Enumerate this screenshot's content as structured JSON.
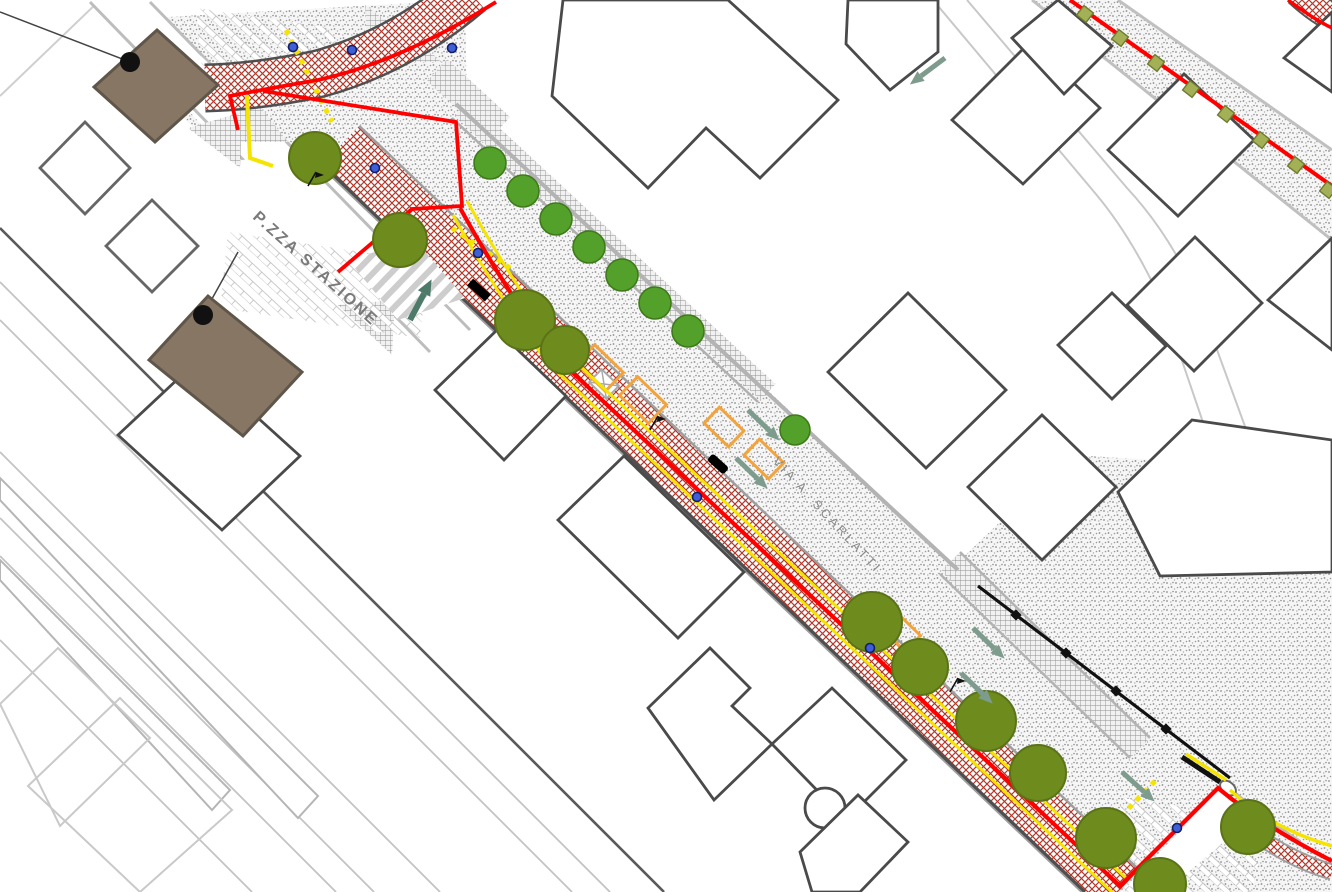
{
  "labels": {
    "piazza": "P.ZZA STAZIONE",
    "via": "VIA A. SCARLATTI"
  },
  "palette": {
    "project_boundary_red": "#FF0000",
    "lane_yellow": "#F5E400",
    "paving_crosshatch_red": "#B2392C",
    "tree_olive": "#6E8B1E",
    "tree_bright_green": "#53A02B",
    "station_building_brown": "#877663",
    "building_outline_gray": "#4A4A4A",
    "curb_gray": "#B3B3B3",
    "marker_blue": "#3E5FD7",
    "arrow_sage_green": "#7E9C8D",
    "arrow_teal_green": "#4E7A69",
    "parking_bay_orange": "#F2A33C",
    "wall_black": "#111111",
    "label_gray": "#7A7A7A"
  },
  "features": {
    "station_square": "P.zza Stazione plaza with parking stalls",
    "main_street": "Via A. Scarlatti with stippled roadway",
    "sidewalk_band": "red crosshatched pavement with project boundary line",
    "railway": "railway tracks and platforms (bottom-left)",
    "tree_rows": "olive street trees and bright green trees",
    "planters": "hatched green planter squares (top-right street)",
    "crossings": "zebra pedestrian crossing and yellow dotted lines"
  }
}
